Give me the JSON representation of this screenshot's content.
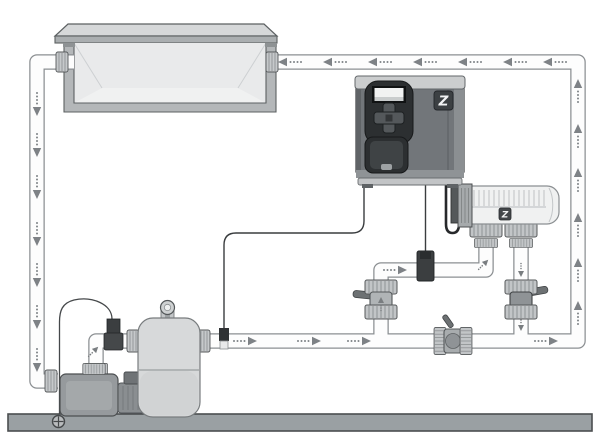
{
  "canvas": {
    "width": 610,
    "height": 447
  },
  "diagram": {
    "kind": "pool-equipment-installation-schematic",
    "brand_marks": {
      "controller_logo": "Z",
      "cell_logo": "Z"
    },
    "palette": {
      "background": "#ffffff",
      "outline": "#55585a",
      "pipe_fill": "#fdfdfd",
      "pipe_outline": "#8b8f92",
      "arrow": "#7e8286",
      "pool_interior": "#e9eaeb",
      "masonry": "#b4b7b9",
      "equipment_gray": "#969a9d",
      "tank_gray": "#d7d9da",
      "controller_body": "#72767a",
      "controller_panel": "#2c2f31",
      "cable": "#35383a",
      "ground_bar": "#9aa0a3"
    },
    "components": [
      "pool",
      "suction-line",
      "return-line",
      "pump",
      "strainer-lid",
      "sand-filter",
      "pressure-gauge",
      "water-probe",
      "controller",
      "lcd-display",
      "navigation-keypad",
      "access-door",
      "flow-sensor",
      "electrolytic-cell",
      "cell-power-cable",
      "cell-inlet-valve",
      "cell-outlet-valve",
      "bypass-valve",
      "earth-bond-wire",
      "ground-bar"
    ],
    "flow_arrows": {
      "suction_line": {
        "direction": "down",
        "count": 7
      },
      "return_line": {
        "direction": "left",
        "count": 7
      },
      "riser_to_pool": {
        "direction": "up",
        "count": 6
      },
      "equipment_line": {
        "direction": "right",
        "count": 5
      }
    }
  }
}
